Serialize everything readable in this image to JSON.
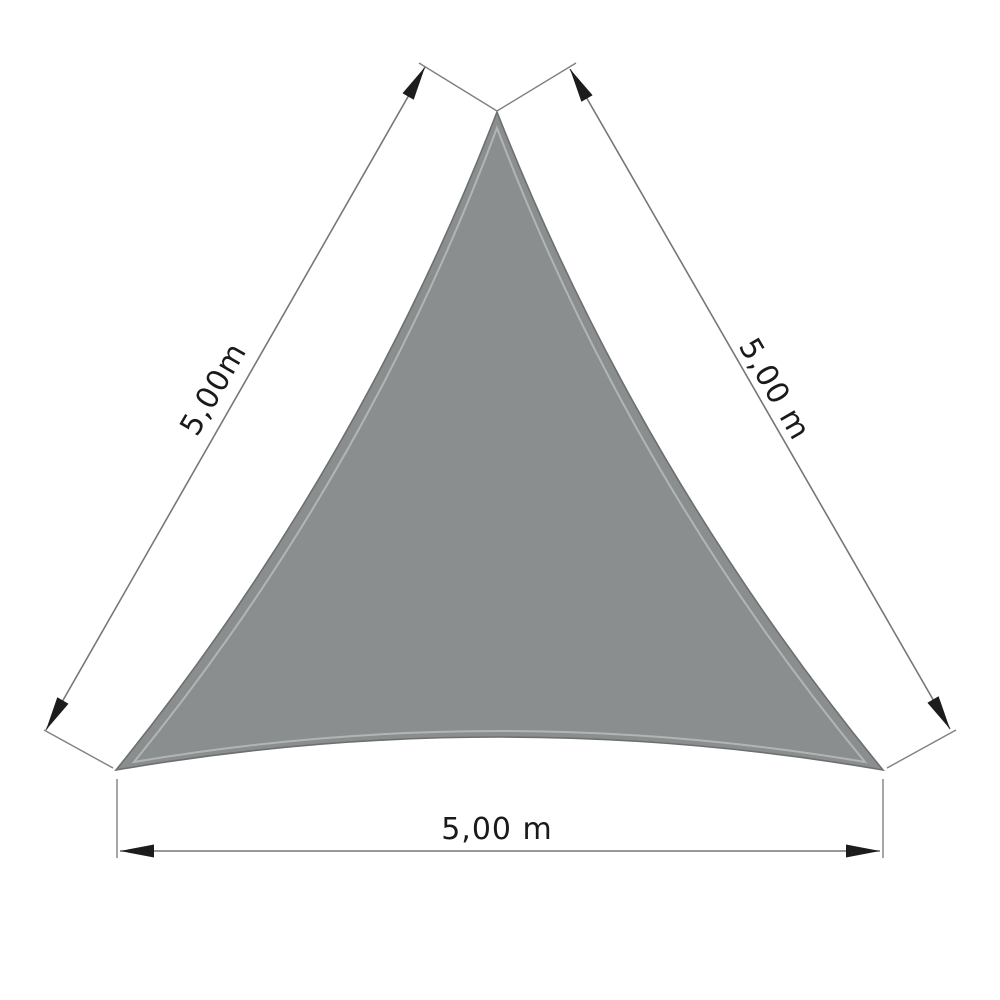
{
  "diagram": {
    "type": "dimension-drawing",
    "labels": {
      "side_left": "5,00m",
      "side_right": "5,00 m",
      "side_bottom": "5,00 m"
    },
    "colors": {
      "background": "#ffffff",
      "sail_fill": "#8a8e8e",
      "sail_edge": "#6d7070",
      "sail_seam": "#b2b5b5",
      "dimension_line": "#777777",
      "extension_line": "#808080",
      "arrow": "#1c1c1c",
      "text": "#1a1a1a"
    }
  }
}
